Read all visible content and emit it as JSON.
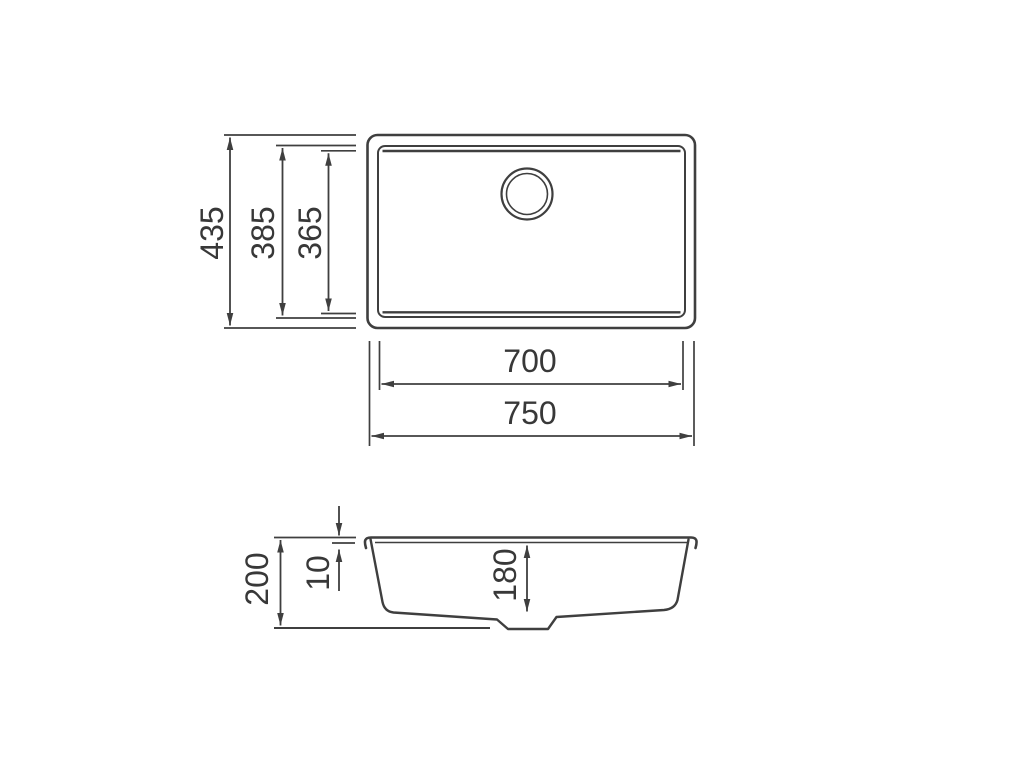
{
  "meta": {
    "background_color": "#ffffff",
    "line_color": "#3f3f3f",
    "text_color": "#383838"
  },
  "views": {
    "top_view": {
      "dimensions": {
        "overall_depth": "435",
        "inner_rim_depth": "385",
        "bowl_depth": "365",
        "bowl_width": "700",
        "overall_width": "750"
      }
    },
    "section_view": {
      "dimensions": {
        "overall_height": "200",
        "rim_thickness": "10",
        "bowl_inner_depth": "180"
      }
    }
  }
}
